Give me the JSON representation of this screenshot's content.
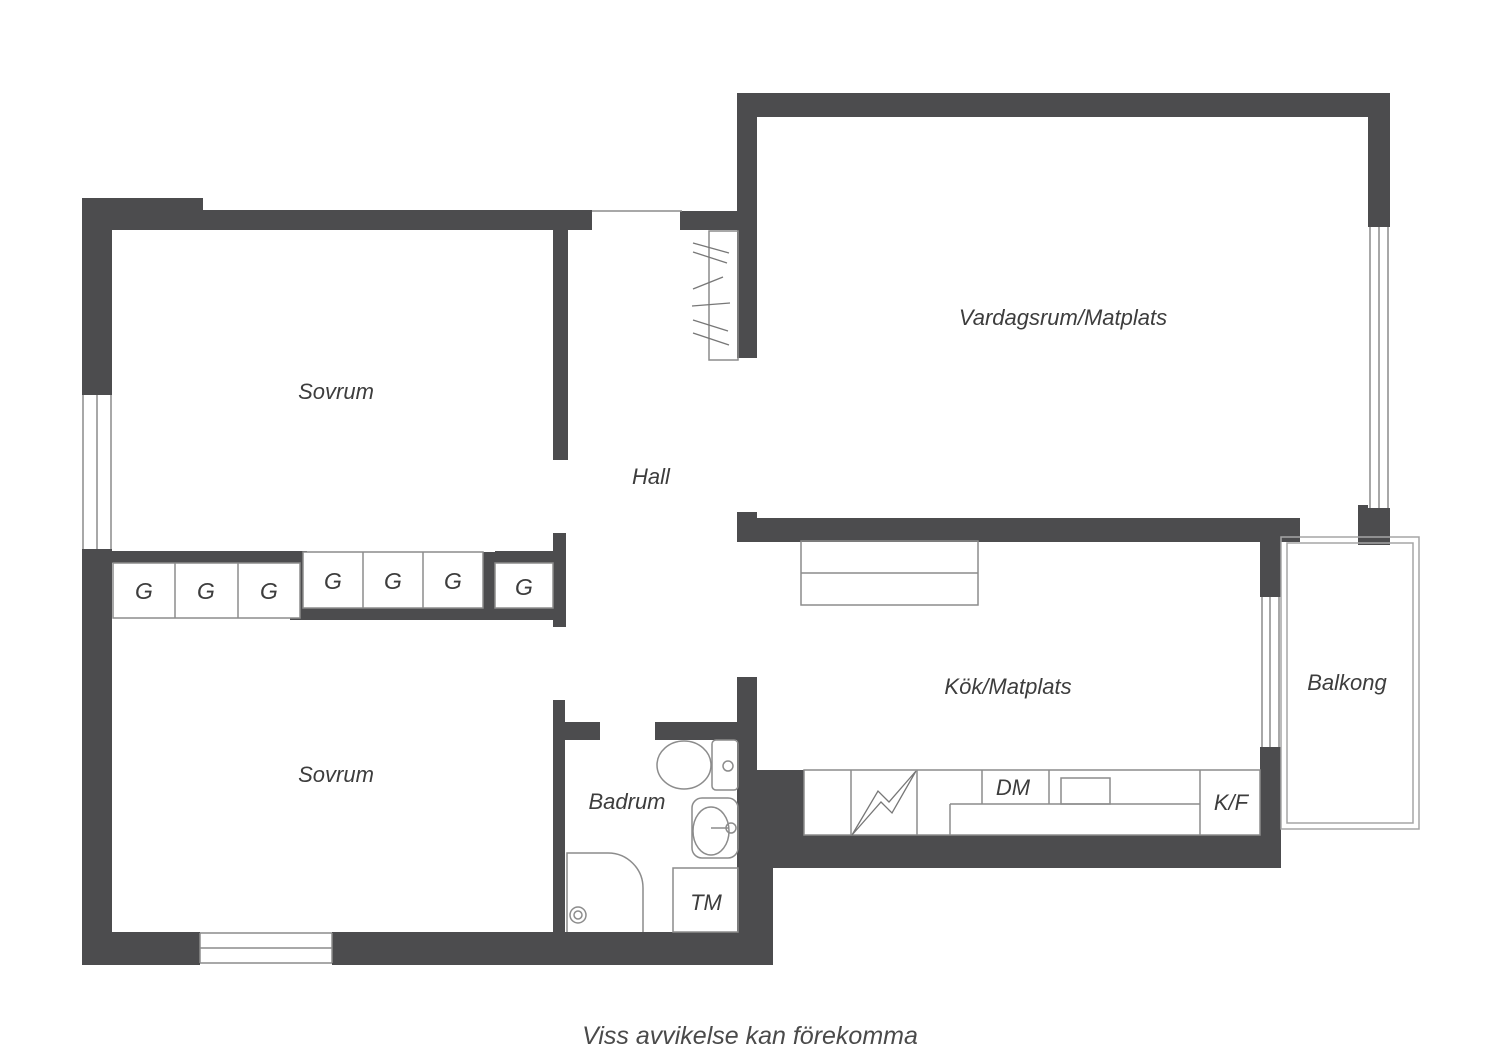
{
  "plan": {
    "type": "apartment-floor-plan",
    "language": "Swedish"
  },
  "colors": {
    "wall": "#4c4c4e",
    "thin_line": "#8c8c8c",
    "balcony_line": "#a5a5a5",
    "text": "#3d3d3d",
    "background": "#ffffff"
  },
  "rooms": {
    "sovrum1": {
      "label": "Sovrum"
    },
    "hall": {
      "label": "Hall"
    },
    "vardagsrum": {
      "label": "Vardagsrum/Matplats"
    },
    "sovrum2": {
      "label": "Sovrum"
    },
    "badrum": {
      "label": "Badrum"
    },
    "kok": {
      "label": "Kök/Matplats"
    },
    "balkong": {
      "label": "Balkong"
    }
  },
  "closets": [
    "G",
    "G",
    "G",
    "G",
    "G",
    "G",
    "G"
  ],
  "appliances": {
    "dm": {
      "label": "DM"
    },
    "kf": {
      "label": "K/F"
    },
    "tm": {
      "label": "TM"
    },
    "stove": {
      "symbol": "lightning-bolt"
    }
  },
  "disclaimer": {
    "text": "Viss avvikelse kan förekomma"
  }
}
